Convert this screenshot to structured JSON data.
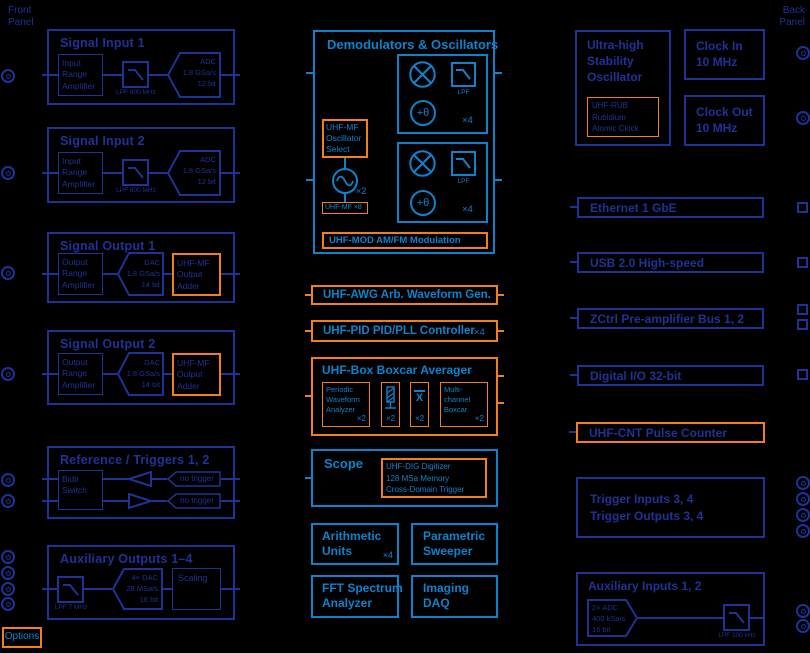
{
  "panels": {
    "front": "Front\nPanel",
    "back": "Back\nPanel"
  },
  "options_label": "Options",
  "colors": {
    "navy": "#1f3296",
    "bright": "#0e82cc",
    "orange": "#f28019",
    "background": "#000000"
  },
  "l": {
    "si1": {
      "t": "Signal Input 1",
      "amp": "Input\nRange\nAmplifier",
      "lpf": "LPF 600 MHz",
      "adc": "ADC\n1.8 GSa/s\n12 bit"
    },
    "si2": {
      "t": "Signal Input 2",
      "amp": "Input\nRange\nAmplifier",
      "lpf": "LPF 600 MHz",
      "adc": "ADC\n1.8 GSa/s\n12 bit"
    },
    "so1": {
      "t": "Signal Output 1",
      "amp": "Output\nRange\nAmplifier",
      "dac": "DAC\n1.8 GSa/s\n14 bit",
      "adder": "UHF-MF\nOutput\nAdder"
    },
    "so2": {
      "t": "Signal Output 2",
      "amp": "Output\nRange\nAmplifier",
      "dac": "DAC\n1.8 GSa/s\n14 bit",
      "adder": "UHF-MF\nOutput\nAdder"
    },
    "ref": {
      "t": "Reference / Triggers 1, 2",
      "sw": "Bidir\nSwitch",
      "tag1": "no trigger",
      "tag2": "no trigger"
    },
    "aux": {
      "t": "Auxiliary Outputs 1–4",
      "lpf": "LPF 7 MHz",
      "dac": "4× DAC\n28 MSa/s\n16 bit",
      "sc": "Scaling"
    }
  },
  "m": {
    "dem": {
      "t": "Demodulators & Oscillators",
      "lpf": "LPF",
      "x4": "×4",
      "osel": "UHF-MF\nOscillator\nSelect",
      "x2": "×2",
      "mf8": "UHF-MF ×8",
      "th": "+θ",
      "mod": "UHF-MOD AM/FM Modulation"
    },
    "awg": "UHF-AWG Arb. Waveform Gen.",
    "pid": "UHF-PID PID/PLL Controller",
    "pidx": "×4",
    "box": {
      "t": "UHF-Box Boxcar Averager",
      "pwa": "Periodic\nWaveform\nAnalyzer",
      "mc": "Multi-\nchannel\nBoxcar",
      "x2": "×2",
      "xbar": "X"
    },
    "scope": {
      "t": "Scope",
      "dig": "UHF-DIG Digitizer\n128 MSa Memory\nCross-Domain Trigger"
    },
    "ar": "Arithmetic\nUnits",
    "arx": "×4",
    "sw": "Parametric\nSweeper",
    "fft": "FFT Spectrum\nAnalyzer",
    "daq": "Imaging\nDAQ"
  },
  "r": {
    "uhso": {
      "t": "Ultra-high\nStability\nOscillator",
      "rub": "UHF-RUB\nRubidium\nAtomic Clock"
    },
    "cin": "Clock In\n10 MHz",
    "cout": "Clock Out\n10 MHz",
    "eth": "Ethernet 1 GbE",
    "usb": "USB 2.0 High-speed",
    "zctrl": "ZCtrl Pre-amplifier Bus 1, 2",
    "dio": "Digital I/O 32-bit",
    "cnt": "UHF-CNT Pulse Counter",
    "trig": "Trigger Inputs 3, 4\nTrigger Outputs 3, 4",
    "aux": {
      "t": "Auxiliary Inputs 1, 2",
      "adc": "2× ADC\n400 kSa/s\n16 bit",
      "lpf": "LPF 100 kHz"
    }
  }
}
